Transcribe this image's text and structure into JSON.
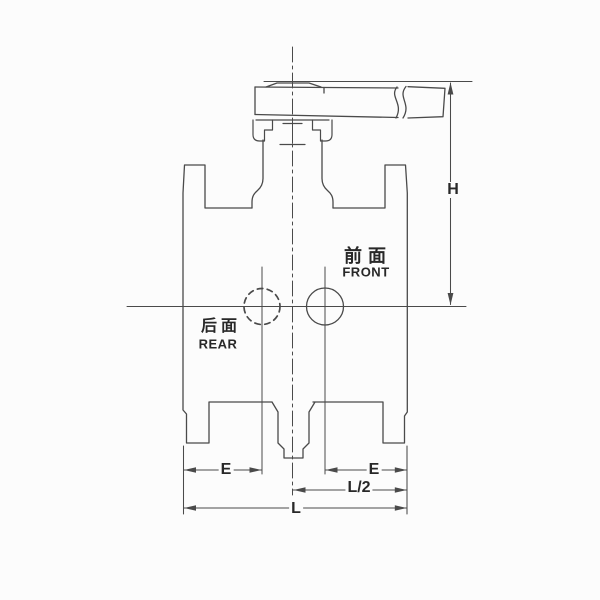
{
  "view_labels": {
    "front": {
      "zh": "前面",
      "en": "FRONT"
    },
    "rear": {
      "zh": "后面",
      "en": "REAR"
    }
  },
  "dimension_labels": {
    "height": "H",
    "end_left": "E",
    "end_right": "E",
    "half_length": "L/2",
    "overall_length": "L"
  },
  "colors": {
    "background": "#fcfcfc",
    "line": "#4a4a4a",
    "text": "#282828"
  }
}
